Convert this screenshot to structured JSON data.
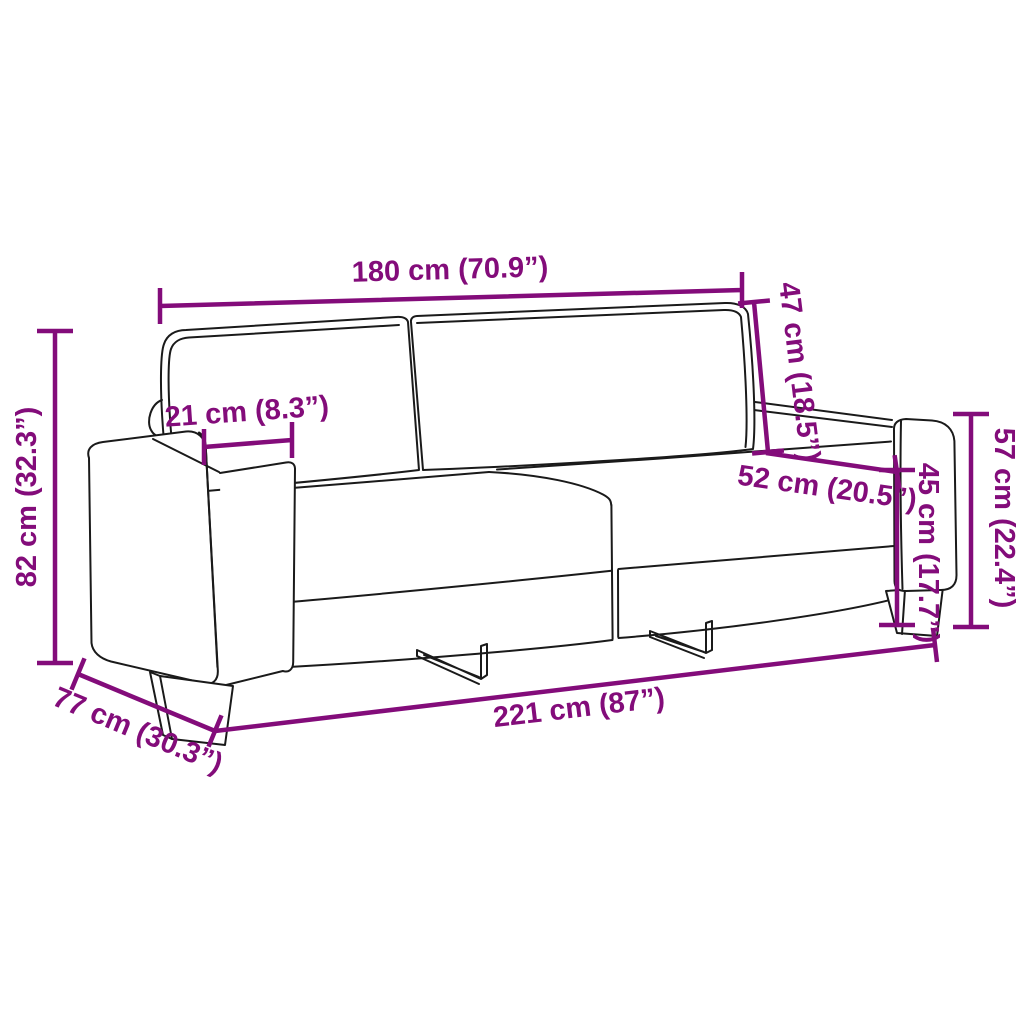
{
  "diagram": {
    "subject": "3-seater sofa technical line drawing with dimension annotations",
    "accent_color": "#830C7A",
    "outline_color": "#1a1a1a",
    "background_color": "#ffffff",
    "dimensions": [
      {
        "id": "back-width",
        "cm": 180,
        "inch": "70.9",
        "label": "180 cm (70.9”)"
      },
      {
        "id": "backrest-height",
        "cm": 47,
        "inch": "18.5",
        "label": "47 cm (18.5”)"
      },
      {
        "id": "armrest-width",
        "cm": 21,
        "inch": "8.3",
        "label": "21 cm (8.3”)"
      },
      {
        "id": "seat-depth",
        "cm": 52,
        "inch": "20.5",
        "label": "52 cm (20.5”)"
      },
      {
        "id": "seat-height",
        "cm": 45,
        "inch": "17.7",
        "label": "45 cm (17.7”)"
      },
      {
        "id": "armrest-height",
        "cm": 57,
        "inch": "22.4",
        "label": "57 cm (22.4”)"
      },
      {
        "id": "overall-height",
        "cm": 82,
        "inch": "32.3",
        "label": "82 cm (32.3”)"
      },
      {
        "id": "overall-depth",
        "cm": 77,
        "inch": "30.3",
        "label": "77 cm (30.3”)"
      },
      {
        "id": "overall-width",
        "cm": 221,
        "inch": "87",
        "label": "221 cm (87”)"
      }
    ]
  }
}
